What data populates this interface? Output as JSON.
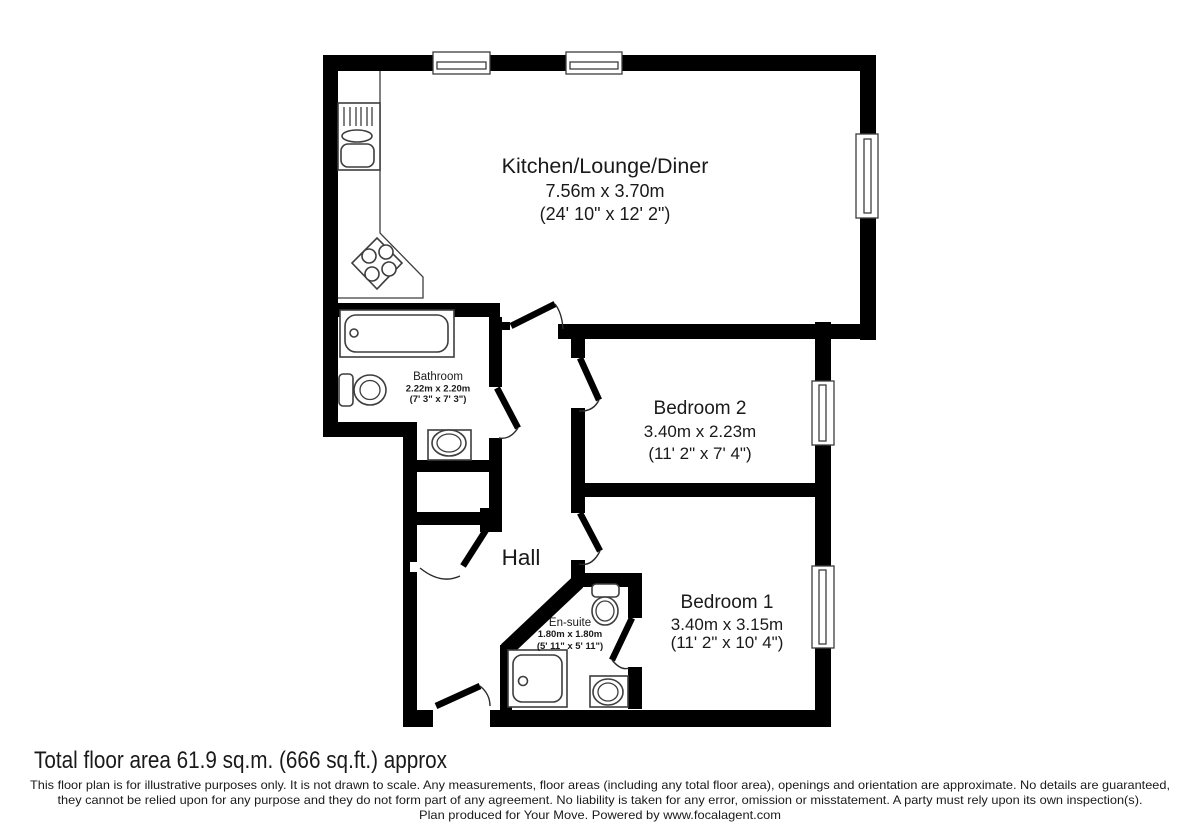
{
  "rooms": {
    "kitchen": {
      "name": "Kitchen/Lounge/Diner",
      "dim_m": "7.56m x 3.70m",
      "dim_ft": "(24' 10\" x 12' 2\")"
    },
    "bedroom2": {
      "name": "Bedroom 2",
      "dim_m": "3.40m x 2.23m",
      "dim_ft": "(11' 2\" x 7' 4\")"
    },
    "bedroom1": {
      "name": "Bedroom 1",
      "dim_m": "3.40m x 3.15m",
      "dim_ft": "(11' 2\" x 10' 4\")"
    },
    "bathroom": {
      "name": "Bathroom",
      "dim_m": "2.22m x 2.20m",
      "dim_ft": "(7' 3\" x 7' 3\")"
    },
    "ensuite": {
      "name": "En-suite",
      "dim_m": "1.80m x 1.80m",
      "dim_ft": "(5' 11\" x 5' 11\")"
    },
    "hall": {
      "name": "Hall"
    }
  },
  "footer": {
    "total_area": "Total floor area 61.9 sq.m. (666 sq.ft.) approx",
    "disclaimer_line1": "This floor plan is for illustrative purposes only. It is not drawn to scale. Any measurements, floor areas (including any total floor area), openings and orientation are approximate. No details are guaranteed,",
    "disclaimer_line2": "they cannot be relied upon for any purpose and they do not form part of any agreement. No liability is taken for any error, omission or misstatement. A party must rely upon its own inspection(s).",
    "disclaimer_line3": "Plan produced for Your Move. Powered by www.focalagent.com"
  },
  "colors": {
    "wall": "#000000",
    "fixture_stroke": "#3d3d3d",
    "text": "#1a1a1a",
    "background": "#ffffff"
  }
}
